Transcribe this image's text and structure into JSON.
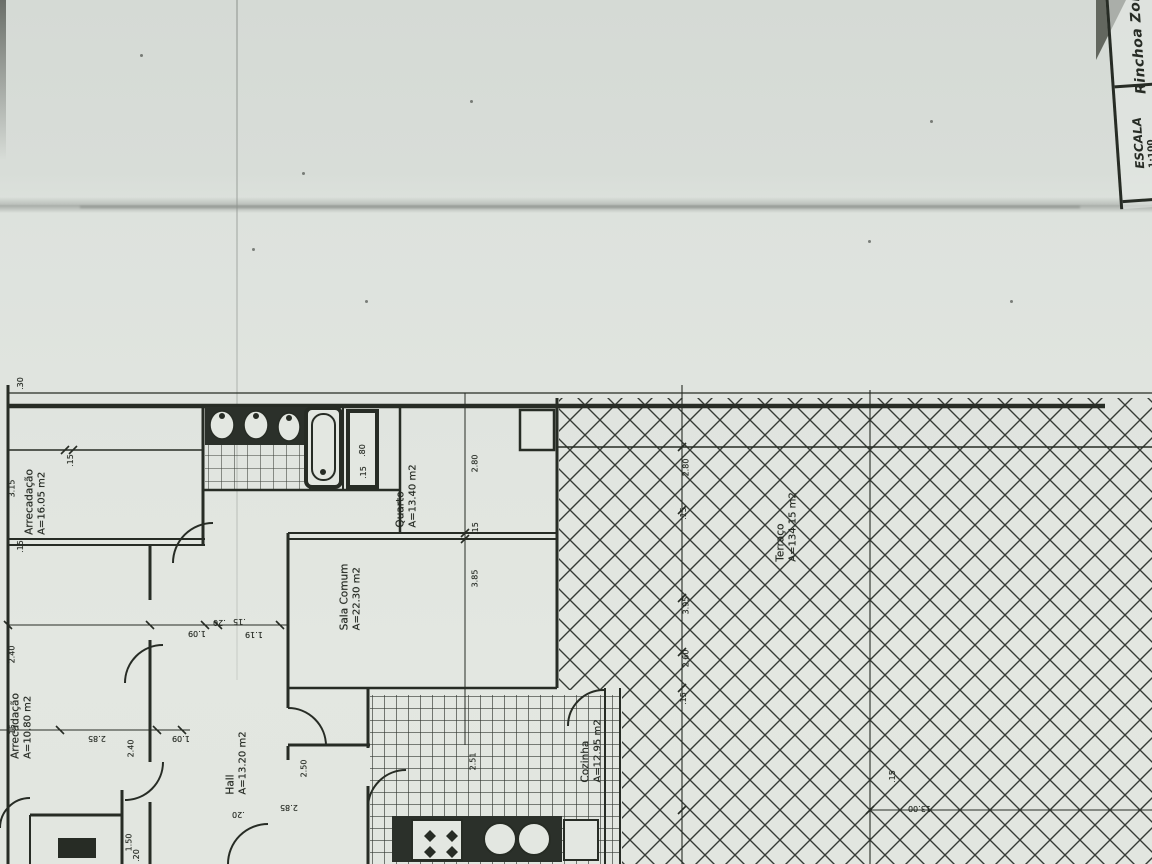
{
  "title_block": {
    "project_name": "Rinchoa Zona",
    "scale_label": "ESCALA",
    "scale_value": "1:100"
  },
  "rooms": [
    {
      "id": "arrecadacao-16",
      "name": "Arrecadação",
      "area": "A=16.05 m2",
      "x": 36,
      "y": 502
    },
    {
      "id": "arrecadacao-10",
      "name": "Arrecadação",
      "area": "A=10.80 m2",
      "x": 22,
      "y": 726
    },
    {
      "id": "quarto",
      "name": "Quarto",
      "area": "A=13.40 m2",
      "x": 407,
      "y": 496
    },
    {
      "id": "sala-comum",
      "name": "Sala Comum",
      "area": "A=22.30 m2",
      "x": 351,
      "y": 597
    },
    {
      "id": "hall",
      "name": "Hall",
      "area": "A=13.20 m2",
      "x": 237,
      "y": 763
    },
    {
      "id": "cozinha",
      "name": "Cozinha",
      "area": "A=12.95 m2",
      "x": 592,
      "y": 751
    },
    {
      "id": "terraco",
      "name": "Terraço",
      "area": "A=134.15 m2",
      "x": 787,
      "y": 527
    }
  ],
  "dimensions": [
    {
      "text": ".30",
      "x": 14,
      "y": 379,
      "rot": -90
    },
    {
      "text": "3.15",
      "x": 3,
      "y": 484,
      "rot": -90
    },
    {
      "text": ".15",
      "x": 64,
      "y": 456,
      "rot": -90
    },
    {
      "text": "2.40",
      "x": 3,
      "y": 650,
      "rot": -90
    },
    {
      "text": ".15",
      "x": 14,
      "y": 542,
      "rot": -90
    },
    {
      "text": "2.80",
      "x": 466,
      "y": 459,
      "rot": -90
    },
    {
      "text": ".15",
      "x": 469,
      "y": 524,
      "rot": -90
    },
    {
      "text": "3.85",
      "x": 466,
      "y": 574,
      "rot": -90
    },
    {
      "text": ".80",
      "x": 356,
      "y": 446,
      "rot": -90
    },
    {
      "text": ".15",
      "x": 357,
      "y": 468,
      "rot": -90
    },
    {
      "text": "1.09",
      "x": 188,
      "y": 629,
      "rot": 180
    },
    {
      "text": ".20",
      "x": 213,
      "y": 618,
      "rot": 180
    },
    {
      "text": ".15",
      "x": 233,
      "y": 617,
      "rot": 180
    },
    {
      "text": "1.19",
      "x": 245,
      "y": 630,
      "rot": 180
    },
    {
      "text": "2.85",
      "x": 88,
      "y": 734,
      "rot": 180
    },
    {
      "text": "1.09",
      "x": 172,
      "y": 734,
      "rot": 180
    },
    {
      "text": ".15",
      "x": 6,
      "y": 726,
      "rot": -90
    },
    {
      "text": "2.40",
      "x": 122,
      "y": 744,
      "rot": -90
    },
    {
      "text": "1.50",
      "x": 120,
      "y": 838,
      "rot": -90
    },
    {
      "text": ".20",
      "x": 130,
      "y": 851,
      "rot": -90
    },
    {
      "text": "2.50",
      "x": 295,
      "y": 764,
      "rot": -90
    },
    {
      "text": "2.51",
      "x": 464,
      "y": 757,
      "rot": -90
    },
    {
      "text": "2.80",
      "x": 677,
      "y": 463,
      "rot": -90
    },
    {
      "text": ".15",
      "x": 677,
      "y": 509,
      "rot": -90
    },
    {
      "text": "3.95",
      "x": 677,
      "y": 601,
      "rot": -90
    },
    {
      "text": "2.60",
      "x": 677,
      "y": 654,
      "rot": -90
    },
    {
      "text": ".15",
      "x": 677,
      "y": 694,
      "rot": -90
    },
    {
      "text": "13.00",
      "x": 908,
      "y": 804,
      "rot": 180
    },
    {
      "text": ".15",
      "x": 886,
      "y": 772,
      "rot": -90
    },
    {
      "text": "2.85",
      "x": 280,
      "y": 803,
      "rot": 180
    },
    {
      "text": ".20",
      "x": 232,
      "y": 810,
      "rot": 180
    }
  ],
  "colors": {
    "paper": "#e0e5df",
    "paper_top": "#d7dcd7",
    "ink": "#272c25",
    "hatch": "#363b35",
    "crease": "#b2b7b2"
  }
}
